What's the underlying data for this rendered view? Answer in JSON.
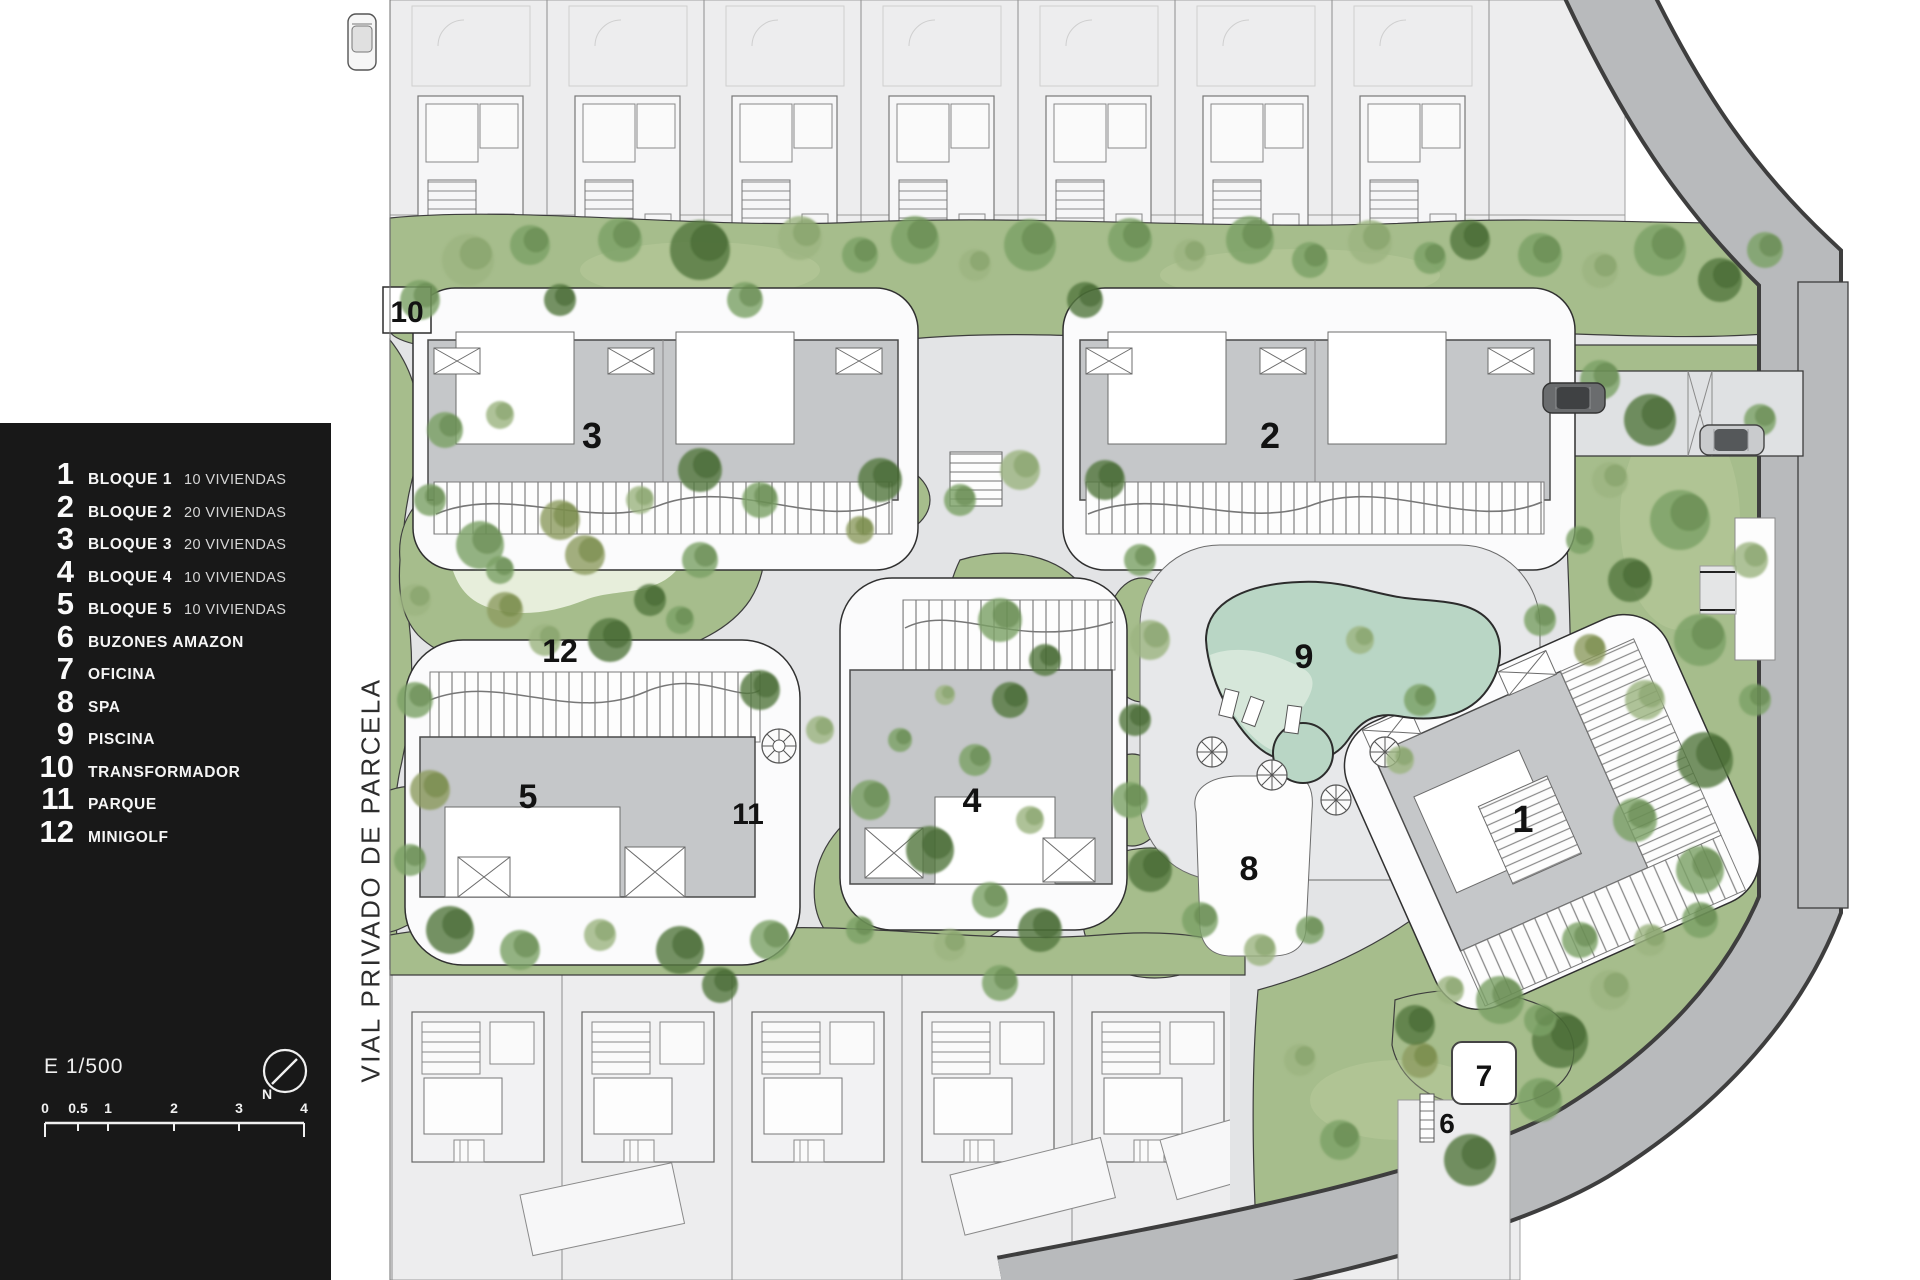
{
  "legend": {
    "items": [
      {
        "num": "1",
        "label": "BLOQUE 1",
        "sub": "10 VIVIENDAS"
      },
      {
        "num": "2",
        "label": "BLOQUE 2",
        "sub": "20 VIVIENDAS"
      },
      {
        "num": "3",
        "label": "BLOQUE 3",
        "sub": "20 VIVIENDAS"
      },
      {
        "num": "4",
        "label": "BLOQUE 4",
        "sub": "10 VIVIENDAS"
      },
      {
        "num": "5",
        "label": "BLOQUE 5",
        "sub": "10 VIVIENDAS"
      },
      {
        "num": "6",
        "label": "BUZONES AMAZON",
        "sub": ""
      },
      {
        "num": "7",
        "label": "OFICINA",
        "sub": ""
      },
      {
        "num": "8",
        "label": "SPA",
        "sub": ""
      },
      {
        "num": "9",
        "label": "PISCINA",
        "sub": ""
      },
      {
        "num": "10",
        "label": "TRANSFORMADOR",
        "sub": ""
      },
      {
        "num": "11",
        "label": "PARQUE",
        "sub": ""
      },
      {
        "num": "12",
        "label": "MINIGOLF",
        "sub": ""
      }
    ]
  },
  "scale": {
    "label": "E 1/500",
    "north": "N",
    "ticks": [
      "0",
      "0.5",
      "1",
      "2",
      "3",
      "4"
    ]
  },
  "road_label": "VIAL PRIVADO DE PARCELA",
  "map": {
    "labels": {
      "block1": "1",
      "block2": "2",
      "block3": "3",
      "block4": "4",
      "block5": "5",
      "buzones": "6",
      "oficina": "7",
      "spa": "8",
      "piscina": "9",
      "transformador": "10",
      "parque": "11",
      "minigolf": "12"
    }
  }
}
